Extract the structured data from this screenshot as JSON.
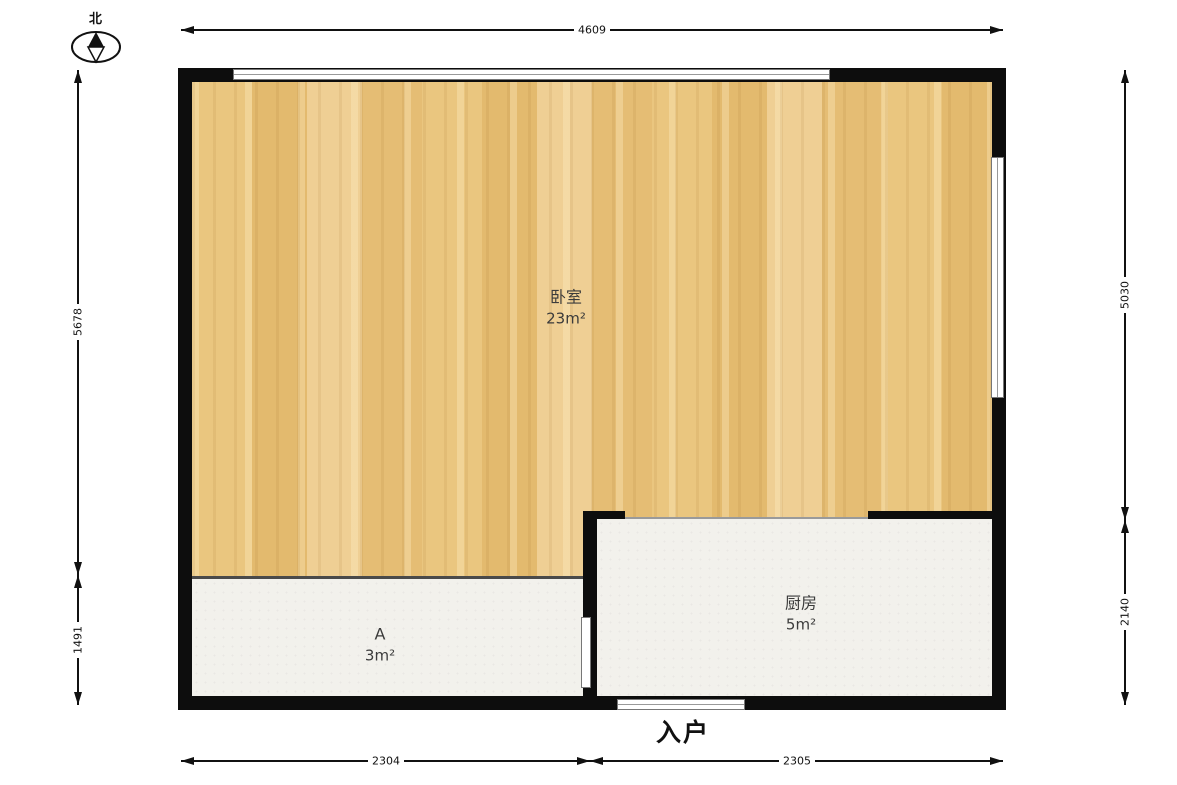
{
  "compass": {
    "north_label": "北"
  },
  "rooms": {
    "bedroom": {
      "name": "卧室",
      "area": "23m²"
    },
    "kitchen": {
      "name": "厨房",
      "area": "5m²"
    },
    "room_a": {
      "name": "A",
      "area": "3m²"
    }
  },
  "entry": {
    "label": "入户"
  },
  "dimensions": {
    "top": "4609",
    "left_upper": "5678",
    "left_lower": "1491",
    "right_upper": "5030",
    "right_lower": "2140",
    "bottom_left": "2304",
    "bottom_right": "2305"
  },
  "colors": {
    "wall": "#0d0d0d",
    "wood_floor": "#e9c37f",
    "tile_floor": "#f2f1ec",
    "dimension_line": "#111111"
  }
}
